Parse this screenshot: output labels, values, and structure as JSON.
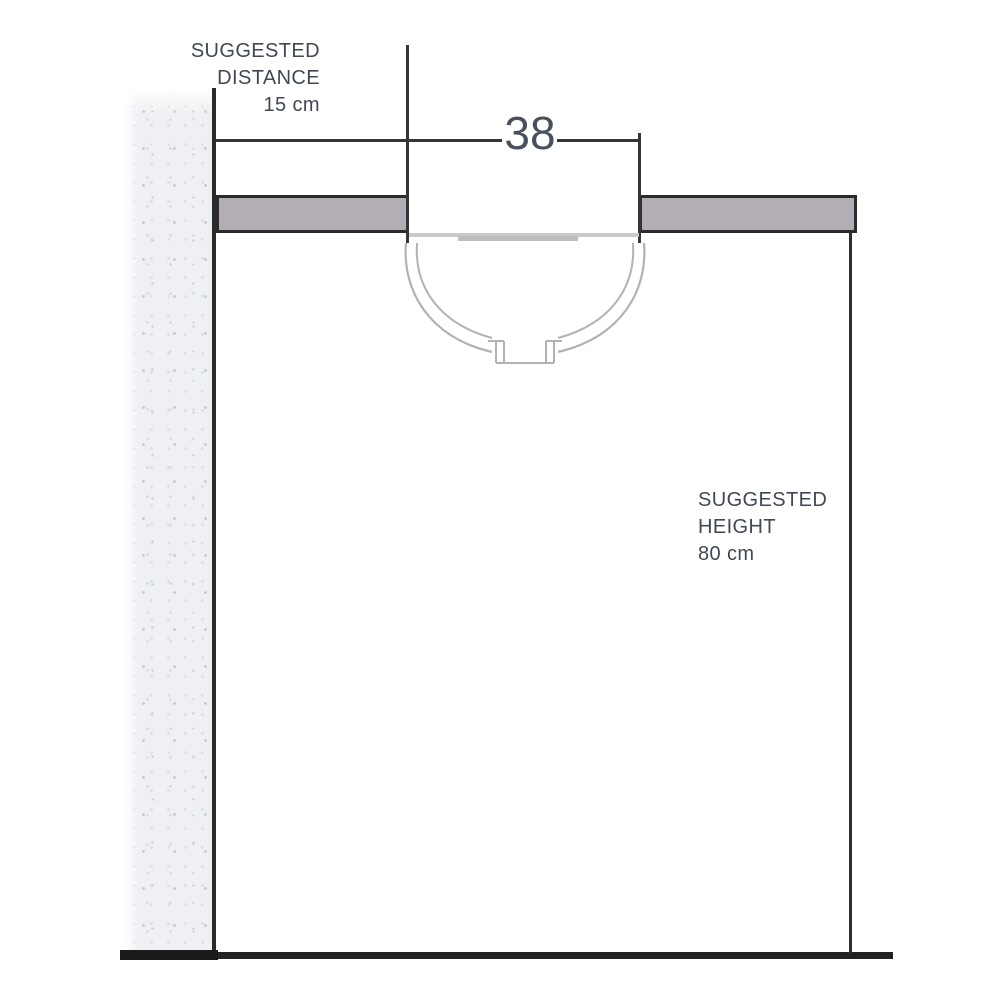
{
  "diagram": {
    "type": "washbasin-installation-side-view",
    "labels": {
      "distance_line1": "SUGGESTED",
      "distance_line2": "DISTANCE",
      "distance_value": "15 cm",
      "width_value": "38",
      "height_line1": "SUGGESTED",
      "height_line2": "HEIGHT",
      "height_value": "80 cm"
    },
    "colors": {
      "counter_fill": "#b3adb5",
      "outline_dark": "#2b2b2b",
      "dimension_line": "#363636",
      "basin_outline": "#b2b2b2",
      "wall_fill": "#eef0f3",
      "text": "#414855",
      "background": "#ffffff"
    }
  }
}
